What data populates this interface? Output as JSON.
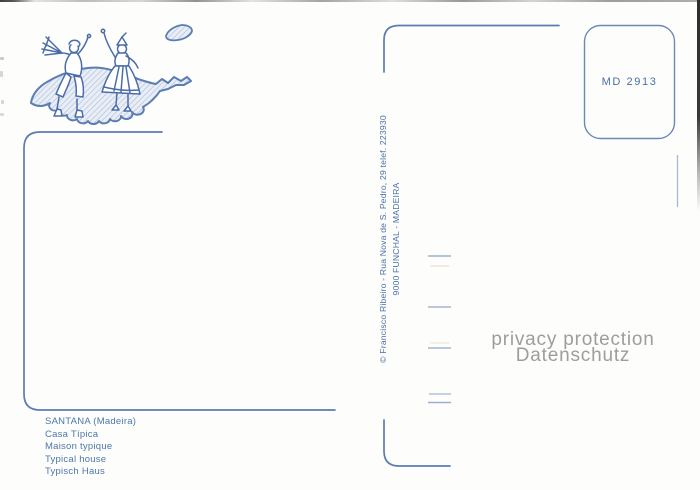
{
  "card": {
    "stamp_code": "MD 2913",
    "publisher": {
      "line1": "© Francisco Ribeiro - Rua Nova de S. Pedro, 29 telef. 223930",
      "line2": "9000 FUNCHAL - MADEIRA"
    },
    "caption": {
      "lines": [
        "SANTANA (Madeira)",
        "Casa Típica",
        "Maison typique",
        "Typical house",
        "Typisch Haus"
      ]
    },
    "watermark": {
      "line1": "privacy protection",
      "line2": "Datenschutz"
    },
    "illustration": "folk-dancers-on-madeira-island-outline",
    "colors": {
      "ink_blue": "#4a70a8",
      "line_blue": "#5b7db1",
      "hatch_blue": "#a9bcd8",
      "watermark_gray": "#9d9d9d"
    }
  }
}
